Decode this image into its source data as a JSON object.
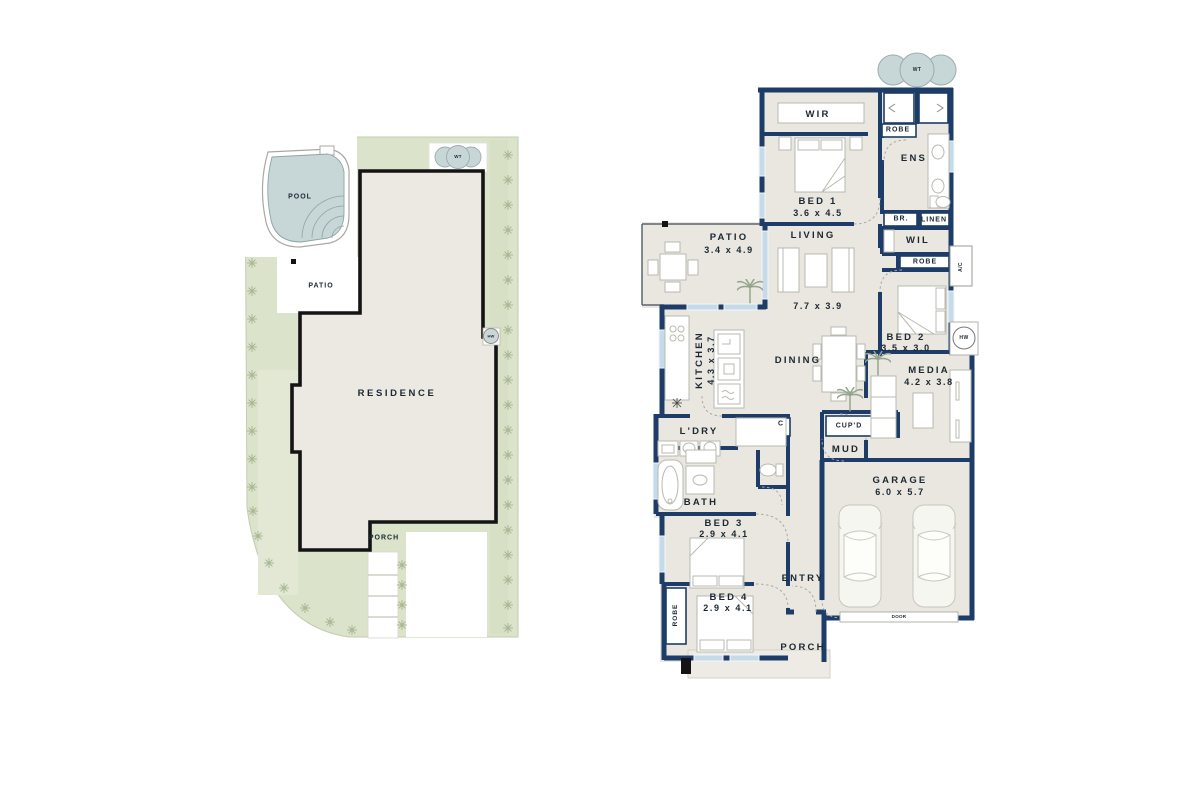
{
  "site_plan": {
    "pool_label": "POOL",
    "wt_label": "WT",
    "patio_label": "PATIO",
    "residence_label": "RESIDENCE",
    "hw_label": "HW",
    "porch_label": "PORCH"
  },
  "floor_plan": {
    "wt_label": "WT",
    "rooms": {
      "wir": {
        "name": "WIR"
      },
      "robe_top": {
        "name": "ROBE"
      },
      "ens": {
        "name": "ENS"
      },
      "bed1": {
        "name": "BED 1",
        "dims": "3.6 x 4.5"
      },
      "br": {
        "name": "BR."
      },
      "linen": {
        "name": "LINEN"
      },
      "wil": {
        "name": "WIL"
      },
      "robe_hall": {
        "name": "ROBE"
      },
      "ac": {
        "name": "A/C"
      },
      "patio": {
        "name": "PATIO",
        "dims": "3.4 x 4.9"
      },
      "living": {
        "name": "LIVING",
        "dims": "7.7 x 3.9"
      },
      "kitchen": {
        "name": "KITCHEN",
        "dims": "4.3 x 3.7"
      },
      "dining": {
        "name": "DINING"
      },
      "bed2": {
        "name": "BED 2",
        "dims": "3.5 x 3.0"
      },
      "hw": {
        "name": "HW"
      },
      "media": {
        "name": "MEDIA",
        "dims": "4.2 x 3.8"
      },
      "cupd": {
        "name": "CUP'D"
      },
      "mud": {
        "name": "MUD"
      },
      "ldry": {
        "name": "L'DRY"
      },
      "closet_c": {
        "name": "C"
      },
      "bath": {
        "name": "BATH"
      },
      "bed3": {
        "name": "BED 3",
        "dims": "2.9 x 4.1"
      },
      "garage": {
        "name": "GARAGE",
        "dims": "6.0 x 5.7"
      },
      "entry": {
        "name": "ENTRY"
      },
      "robe_bed4": {
        "name": "ROBE"
      },
      "bed4": {
        "name": "BED 4",
        "dims": "2.9 x 4.1"
      },
      "porch": {
        "name": "PORCH"
      },
      "garage_door": {
        "name": "DOOR"
      }
    }
  },
  "colors": {
    "wall_navy": "#1d3d68",
    "floor_beige": "#e9e7df",
    "lot_green": "#dce3cb",
    "tree_green": "#a9b894",
    "pool_water": "#c7d6d6",
    "window_glass": "#c5dbe9",
    "outline_black": "#141414"
  },
  "icons": {
    "tree": "starburst-tree",
    "palm": "palm-plant",
    "car": "car-top-view",
    "hw_unit": "hot-water-circle",
    "wt_tank": "water-tank-blob"
  }
}
